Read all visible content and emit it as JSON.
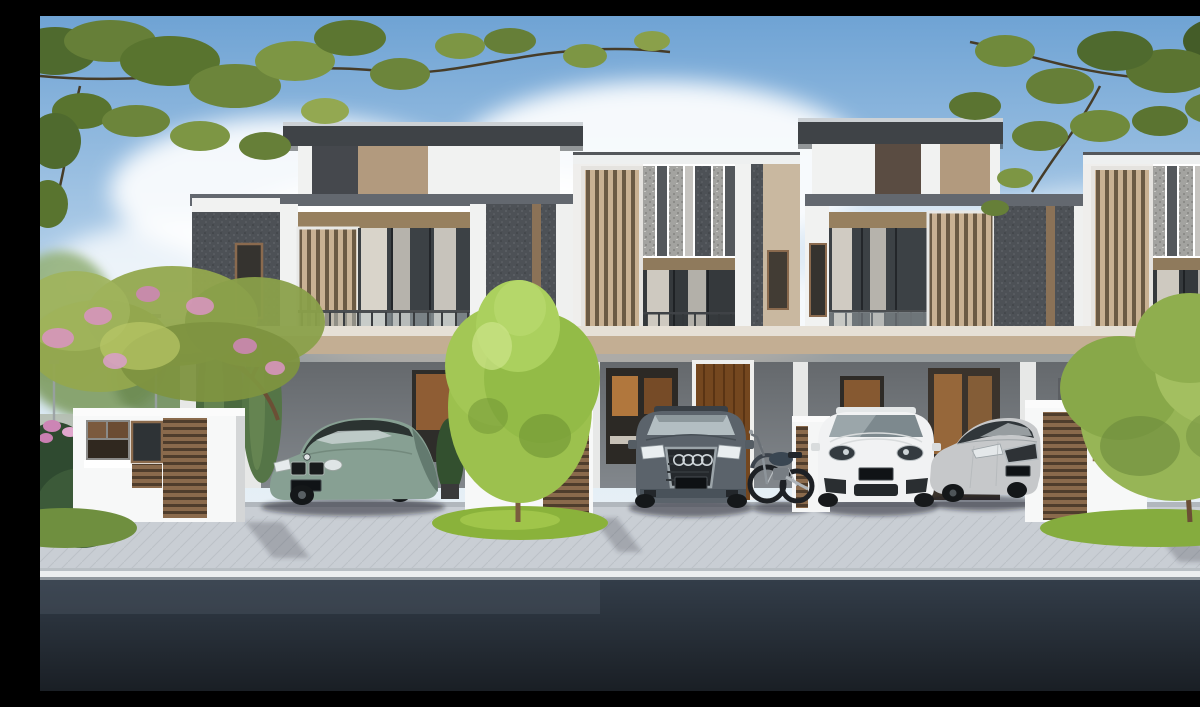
{
  "scene": {
    "type": "exterior architectural rendering",
    "subject": "Row of four modern two-storey terrace houses with private carports",
    "units_visible": 4,
    "facade_styles": [
      "dark textured wall unit with wide cantilevered flat roof, timber louvre screen, curtained glass doors and glass balcony",
      "white frame unit with vertical stone-mosaic strips, full-height timber louvre screen and juliet balcony"
    ],
    "street": {
      "foreground": "dark asphalt road",
      "kerb": "white kerb line",
      "driveway": "light concrete apron with grass pockets"
    },
    "vegetation": [
      "overhanging leafy branches across the top corners",
      "pink flowering tree on the left",
      "bright conical tree in the centre",
      "round leafy tree on the right",
      "columnar shrubs, tropical plants and flower bed"
    ],
    "vehicles": [
      {
        "kind": "executive sedan",
        "badge": "bmw-roundel",
        "color_name": "sage green",
        "position": "left carport"
      },
      {
        "kind": "large SUV",
        "badge": "audi-rings",
        "color_name": "slate grey",
        "position": "second carport"
      },
      {
        "kind": "classic motorcycle",
        "color_name": "black and chrome",
        "position": "beside the grey SUV"
      },
      {
        "kind": "luxury SUV",
        "color_name": "white",
        "position": "third carport"
      },
      {
        "kind": "mid-size sedan",
        "color_name": "silver",
        "position": "third carport, right side"
      }
    ],
    "license_plates_legible": false,
    "sky": "clear blue with large soft white clouds",
    "lighting": "bright daylight from the left"
  },
  "colors": {
    "sky_top": "#6fa3d4",
    "sky_horizon": "#e9f1f6",
    "cloud": "#ffffff",
    "roof": "#3f4347",
    "roof_edge": "#ccd1d5",
    "wall_white": "#f1f2f1",
    "wall_dark": "#4d5156",
    "wall_tan": "#b29a7e",
    "band_gray": "#63686f",
    "header_brown": "#97805f",
    "slab_tan": "#c3ae93",
    "carport_wall": "#82878c",
    "louver_slat": "#c9b193",
    "louver_gap": "#6b5a44",
    "gate_white": "#f7f8f8",
    "gate_louver": "#8a6a4c",
    "door_wood": "#74471f",
    "window_glow": "#b5793f",
    "glass_dark": "#3c4145",
    "curtain": "#eae4d8",
    "pavement": "#c9ced4",
    "curb": "#eceeef",
    "road": "#333d49",
    "grass": "#8ab23b",
    "tree_bright": "#9cc14e",
    "bush": "#97b556",
    "foliage_olive": "#93a84e",
    "blossom_pink": "#d795bd",
    "conifer": "#4b6a3f",
    "car_bmw": "#87a093",
    "car_audi": "#5b636b",
    "car_porsche": "#f1f2f3",
    "car_kia": "#c6c8ca",
    "moto_dark": "#3a4652"
  }
}
